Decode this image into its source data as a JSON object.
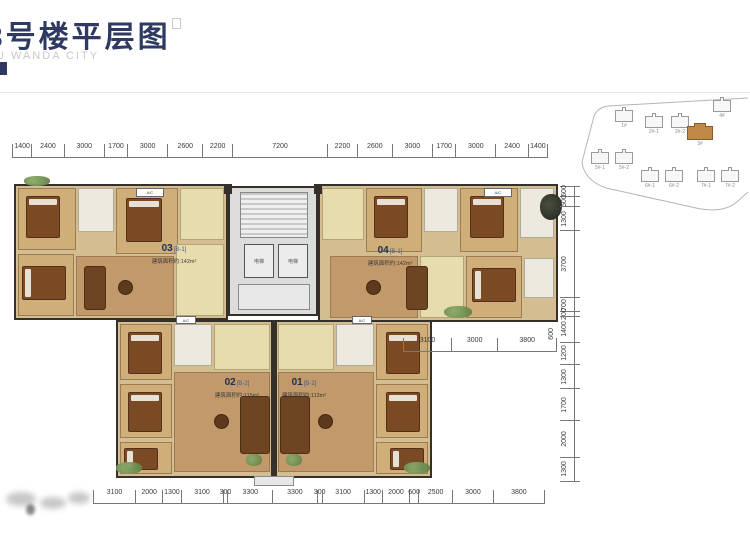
{
  "header": {
    "title": "3号楼平层图",
    "subtitle": "U WANDA CITY"
  },
  "site_plan": {
    "buildings": [
      {
        "label": "1#"
      },
      {
        "label": "2#-1"
      },
      {
        "label": "2#-2"
      },
      {
        "label": "4#"
      },
      {
        "label": "3#",
        "highlight": true
      },
      {
        "label": "5#-1"
      },
      {
        "label": "5#-2"
      },
      {
        "label": "6#-1"
      },
      {
        "label": "6#-2"
      },
      {
        "label": "7#-1"
      },
      {
        "label": "7#-2"
      }
    ]
  },
  "floor_plan": {
    "units": [
      {
        "number": "03",
        "type_code": "[B-1]",
        "area_label": "建筑面积约:142m²"
      },
      {
        "number": "04",
        "type_code": "[B-1]",
        "area_label": "建筑面积约:142m²"
      },
      {
        "number": "02",
        "type_code": "[B-2]",
        "area_label": "建筑面积约:115m²"
      },
      {
        "number": "01",
        "type_code": "[B-2]",
        "area_label": "建筑面积约:113m²"
      }
    ],
    "core": {
      "elevator_label": "电梯"
    },
    "ac_label": "A/C"
  },
  "dimensions": {
    "top": [
      1400,
      2400,
      3000,
      1700,
      3000,
      2600,
      2200,
      7200,
      2200,
      2600,
      3000,
      1700,
      3000,
      2400,
      1400
    ],
    "right": [
      500,
      500,
      1300,
      3700,
      700,
      200,
      1400,
      1200,
      1300,
      1700,
      2000,
      1300
    ],
    "right_overall": "600",
    "mid_right": [
      3100,
      3000,
      3800
    ],
    "bottom": [
      3100,
      2000,
      1300,
      3100,
      300,
      3300,
      3300,
      300,
      3100,
      1300,
      2000,
      600,
      2500,
      3000,
      3800
    ]
  },
  "colors": {
    "title_navy": "#2e3a62",
    "highlight_orange": "#bf8a48",
    "floor_tan": "#d5bd92"
  }
}
